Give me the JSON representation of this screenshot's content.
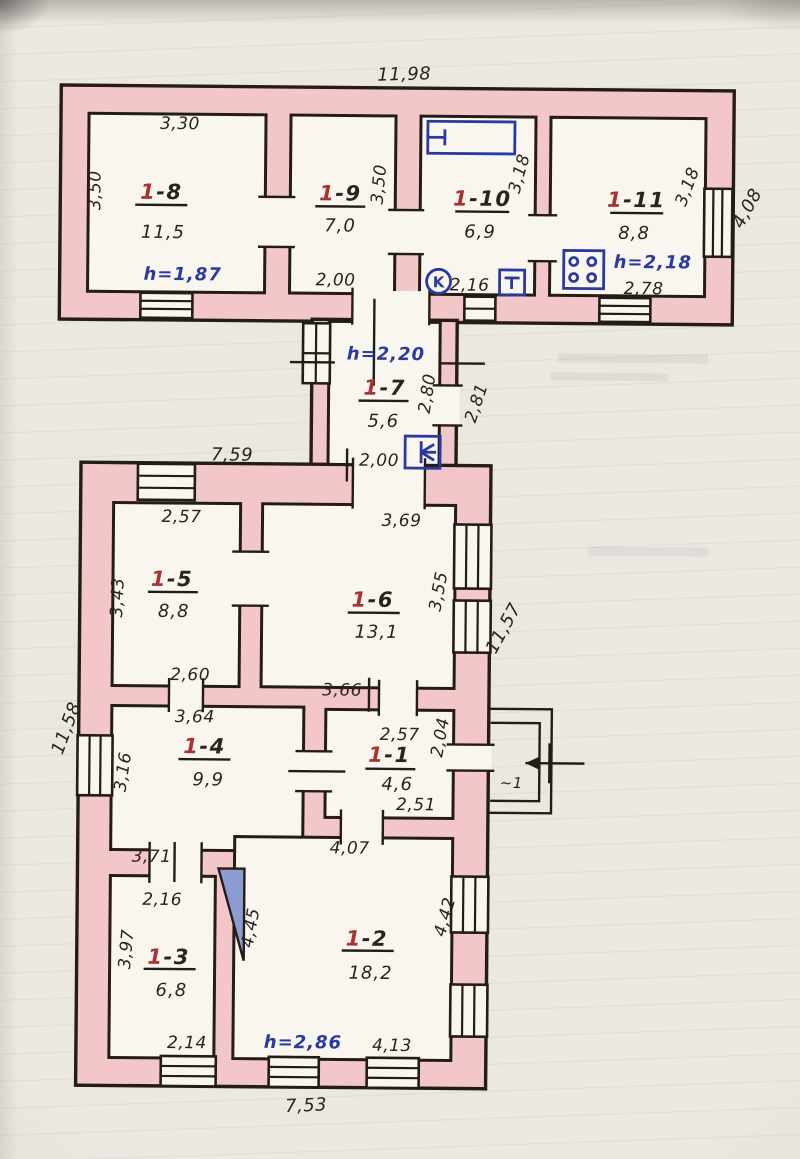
{
  "meta": {
    "drawing_type": "hand-drawn floor plan, pencil and ink on paper"
  },
  "colors": {
    "wall_fill": "#f3c7c9",
    "ink": "#2b241c",
    "room_number_red": "#a93331",
    "pen_blue": "#2b3a9e",
    "paper": "#ebe8e1"
  },
  "overall": {
    "w_top": "11,98",
    "h_right_top": "4,08",
    "w_bottom_block": "7,59",
    "h_left": "11,58",
    "h_right": "11,57",
    "w_bottom": "7,53"
  },
  "rooms": {
    "r1_1": {
      "num": "1",
      "rest": "-1",
      "area": "4,6",
      "dim_top": "2,57",
      "dim_right": "2,04",
      "dim_bottom": "2,51"
    },
    "r1_2": {
      "num": "1",
      "rest": "-2",
      "area": "18,2",
      "h": "h=2,86",
      "dim_top": "4,07",
      "dim_left": "4,45",
      "dim_right": "4,42",
      "dim_bottom": "4,13"
    },
    "r1_3": {
      "num": "1",
      "rest": "-3",
      "area": "6,8",
      "dim_top": "2,16",
      "dim_left": "3,97",
      "dim_bottom": "2,14"
    },
    "r1_4": {
      "num": "1",
      "rest": "-4",
      "area": "9,9",
      "dim_top": "3,64",
      "dim_left": "3,16",
      "dim_bottom": "3,71"
    },
    "r1_5": {
      "num": "1",
      "rest": "-5",
      "area": "8,8",
      "dim_top": "2,57",
      "dim_left": "3,43",
      "dim_bottom": "2,60"
    },
    "r1_6": {
      "num": "1",
      "rest": "-6",
      "area": "13,1",
      "dim_top": "3,69",
      "dim_right": "3,55",
      "dim_bottom": "3,66"
    },
    "r1_7": {
      "num": "1",
      "rest": "-7",
      "area": "5,6",
      "h": "h=2,20",
      "dim_inner": "2,80",
      "dim_outer": "2,81",
      "dim_bottom": "2,00"
    },
    "r1_8": {
      "num": "1",
      "rest": "-8",
      "area": "11,5",
      "h": "h=1,87",
      "dim_top": "3,30",
      "dim_left": "3,50"
    },
    "r1_9": {
      "num": "1",
      "rest": "-9",
      "area": "7,0",
      "dim_right": "3,50",
      "dim_bottom": "2,00"
    },
    "r1_10": {
      "num": "1",
      "rest": "-10",
      "area": "6,9",
      "dim_right": "3,18",
      "dim_bottom": "2,16"
    },
    "r1_11": {
      "num": "1",
      "rest": "-11",
      "area": "8,8",
      "h": "h=2,18",
      "dim_right": "3,18",
      "dim_bottom": "2,78"
    }
  },
  "annotations": {
    "k_mark": "K",
    "porch": "~1"
  },
  "icons": {
    "bathtub": "blue bathtub rectangle in room 1-10",
    "k_circle": "circled letter K in room 1-10",
    "tank": "small square with T mark in room 1-10",
    "stove": "four-burner stove square in room 1-11",
    "vent_fan": "fan/vent square at corridor 1-7",
    "furnace": "blue triangle furnace between rooms 1-3 and 1-2",
    "entrance_arrow": "arrow pointing into porch entrance"
  }
}
